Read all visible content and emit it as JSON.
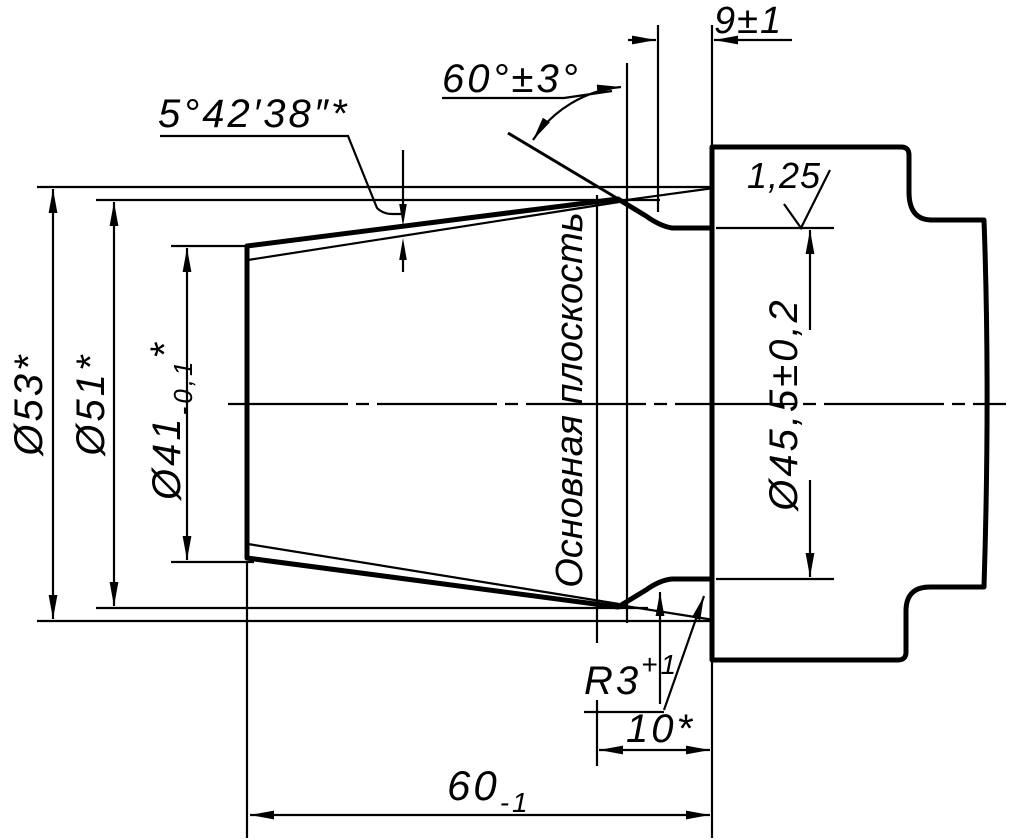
{
  "drawing": {
    "kind": "engineering-drawing-cone-taper-gauge",
    "colors": {
      "line": "#000000",
      "background": "#ffffff"
    },
    "labels": {
      "flange_width": "9±1",
      "chamfer_angle": "60°±3°",
      "taper_half_angle": "5°42′38″*",
      "surface_roughness": "1,25",
      "dia_53": "Ø53*",
      "dia_51": "Ø51*",
      "dia_41": "Ø41",
      "dia_41_tolerance": "-0,1",
      "dia_41_note": "*",
      "dia_45_5": "Ø45,5±0,2",
      "basic_plane": "Основная плоскость",
      "fillet_radius": "R3",
      "fillet_radius_tolerance": "+1",
      "basic_plane_distance": "10*",
      "cone_length": "60",
      "cone_length_tolerance": "-1"
    }
  }
}
